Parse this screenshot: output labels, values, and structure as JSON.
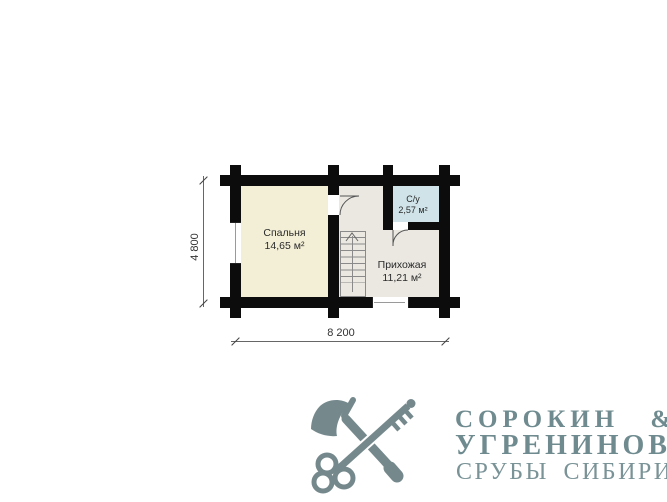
{
  "plan": {
    "rooms": {
      "bedroom": {
        "name": "Спальня",
        "area": "14,65 м²"
      },
      "hallway": {
        "name": "Прихожая",
        "area": "11,21 м²"
      },
      "bathroom": {
        "name": "С/у",
        "area": "2,57 м²"
      }
    },
    "dimensions": {
      "vertical": "4 800",
      "horizontal": "8 200"
    },
    "colors": {
      "wall": "#0c0c0c",
      "bedroom_floor": "#f3efd6",
      "hallway_floor": "#eae8e1",
      "bathroom_floor": "#cfe3e9",
      "lines": "#666666"
    },
    "icons": [
      "stairs-up-arrow-icon",
      "door-swing-arc"
    ]
  },
  "logo": {
    "line1": "СОРОКИН &",
    "line2": "УГРЕНИНОВ",
    "line3": "СРУБЫ СИБИРИ",
    "icon": "axe-and-key-icon",
    "colors": {
      "icon": "#75898d",
      "title": "#6f8b8f",
      "subtitle": "#7a9397"
    }
  }
}
